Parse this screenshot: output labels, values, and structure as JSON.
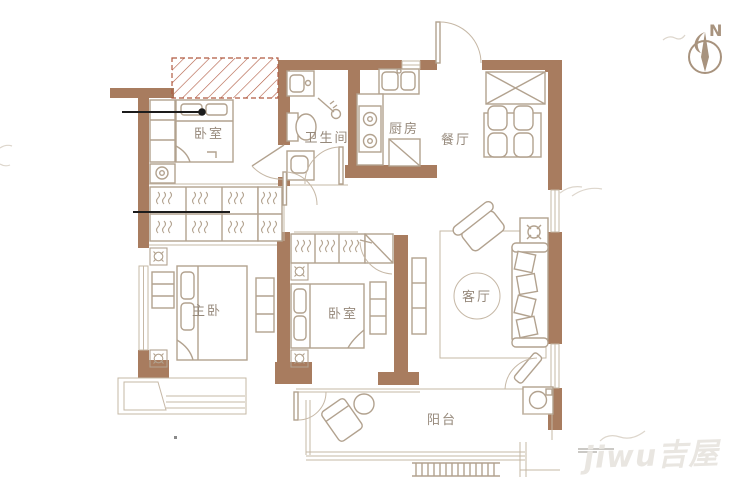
{
  "rooms": {
    "bedroom_top": "卧室",
    "bathroom": "卫生间",
    "kitchen": "厨房",
    "dining": "餐厅",
    "master_bedroom": "主卧",
    "bedroom_middle": "卧室",
    "living_room": "客厅",
    "balcony": "阳台"
  },
  "compass": {
    "north_label": "N"
  },
  "watermark": {
    "text": "jiwu吉屋"
  },
  "colors": {
    "wall": "#a87c5f",
    "furniture": "#b2a28f",
    "thin": "#c6b8a6",
    "hatch": "#b05a41",
    "label": "#96897b",
    "annotation": "#1c1c1c",
    "watermark": "#e9e6e1",
    "compass": "#a8937e"
  }
}
